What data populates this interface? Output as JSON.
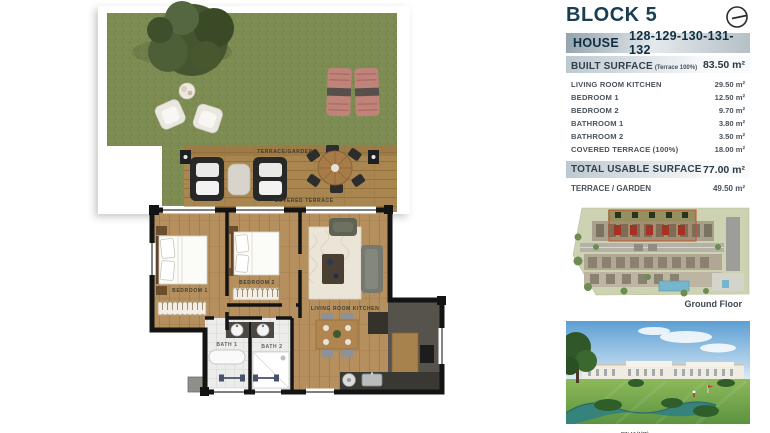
{
  "accent_color": "#173e52",
  "floorplan": {
    "labels": {
      "terrace_garden": "TERRACE/GARDEN",
      "covered_terrace": "COVERED TERRACE",
      "bedroom1": "BEDROOM 1",
      "bedroom2": "BEDROOM 2",
      "living": "LIVING ROOM KITCHEN",
      "bath1": "BATH 1",
      "bath2": "BATH 2"
    }
  },
  "panel": {
    "block_title": "BLOCK 5",
    "house": {
      "label": "HOUSE",
      "numbers": "128-129-130-131-132"
    },
    "built": {
      "label": "BUILT SURFACE",
      "note": "(Terrace 100%)",
      "value": "83.50 m²"
    },
    "details": [
      {
        "label": "LIVING ROOM KITCHEN",
        "value": "29.50 m²"
      },
      {
        "label": "BEDROOM 1",
        "value": "12.50 m²"
      },
      {
        "label": "BEDROOM 2",
        "value": "9.70 m²"
      },
      {
        "label": "BATHROOM 1",
        "value": "3.80 m²"
      },
      {
        "label": "BATHROOM 2",
        "value": "3.50 m²"
      },
      {
        "label": "COVERED TERRACE (100%)",
        "value": "18.00 m²"
      }
    ],
    "total": {
      "label": "TOTAL USABLE SURFACE",
      "value": "77.00 m²"
    },
    "terrace_row": {
      "label": "TERRACE / GARDEN",
      "value": "49.50 m²"
    },
    "site_plan_caption": "Ground Floor",
    "scale_note": "DIN A3 (1/75)",
    "icons": {
      "compass": "north-indicator"
    }
  }
}
